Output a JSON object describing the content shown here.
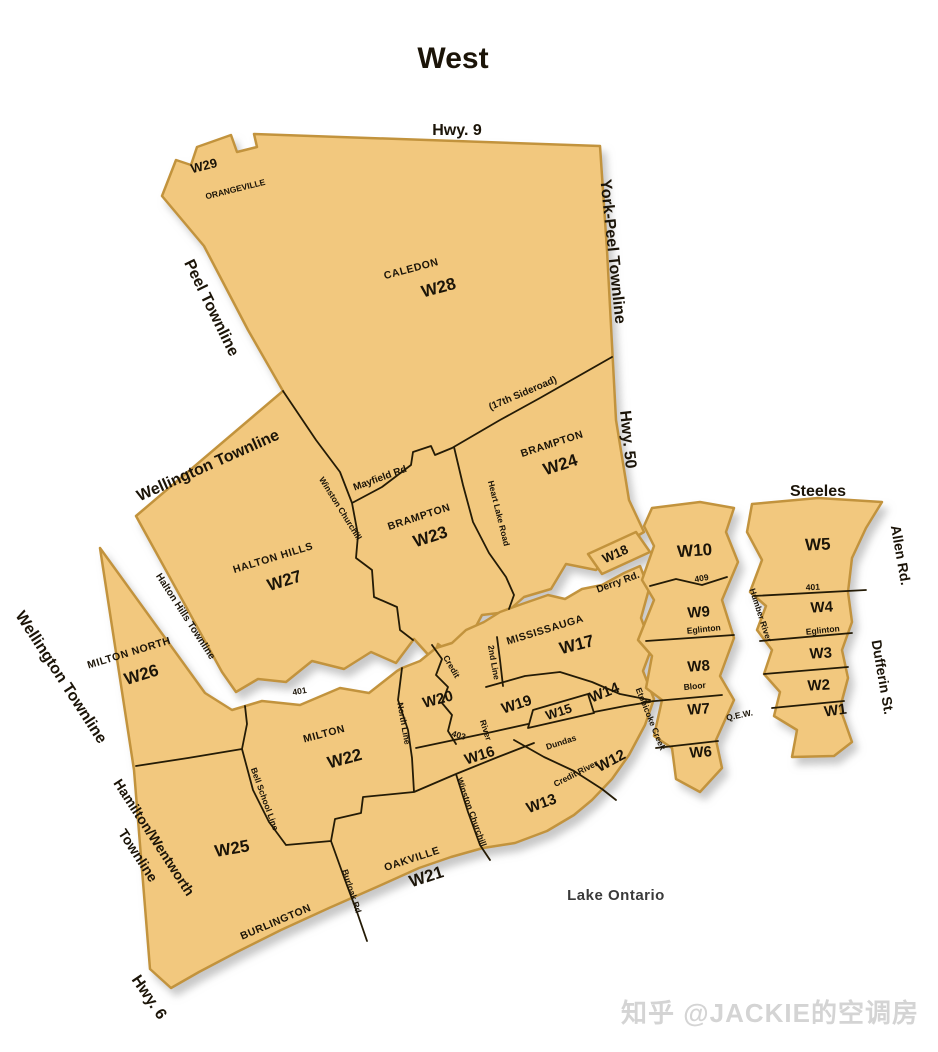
{
  "colors": {
    "background": "#FFFFFF",
    "region_fill": "#F2C87E",
    "region_edge": "#C2933C",
    "boundary_line": "#241B06",
    "label_text": "#1B1408",
    "lake_text": "#3A3A3A",
    "watermark": "#D4D4D4"
  },
  "labels": {
    "title": "West",
    "hwy9": "Hwy. 9",
    "w29": "W29",
    "orangeville": "ORANGEVILLE",
    "york_peel": "York-Peel Townline",
    "peel_townline": "Peel Townline",
    "caledon": "CALEDON",
    "w28": "W28",
    "sideroad17": "(17th Sideroad)",
    "hwy50": "Hwy. 50",
    "wellington_nw": "Wellington Townline",
    "mayfield": "Mayfield Rd",
    "winston_n": "Winston Churchill",
    "heart_lake": "Heart Lake Road",
    "brampton23": "BRAMPTON",
    "w23": "W23",
    "brampton24": "BRAMPTON",
    "w24": "W24",
    "halton_hills_name": "HALTON HILLS",
    "w27": "W27",
    "halton_hills_townline": "Halton Hills Townline",
    "milton_north": "MILTON NORTH",
    "w26": "W26",
    "wellington_sw": "Wellington Townline",
    "hamilton1": "Hamilton/Wentworth",
    "hamilton2": "Townline",
    "hwy6": "Hwy. 6",
    "w25": "W25",
    "burlington": "BURLINGTON",
    "milton": "MILTON",
    "w22": "W22",
    "oakville": "OAKVILLE",
    "w21": "W21",
    "bell_school": "Bell School Line",
    "burloak": "Burloak Rd",
    "north_line": "North Line",
    "r401a": "401",
    "r401b": "401",
    "r403": "403",
    "r409": "409",
    "credit": "Credit",
    "river": "River",
    "second_line": "2nd Line",
    "credit_river": "Credit River",
    "winston_s": "Winston Churchill",
    "mississauga": "MISSISSAUGA",
    "w17": "W17",
    "w18": "W18",
    "derry": "Derry Rd.",
    "w19": "W19",
    "w20": "W20",
    "w16": "W16",
    "w15": "W15",
    "w14": "W14",
    "w13": "W13",
    "w12": "W12",
    "dundas": "Dundas",
    "etobicoke_creek": "Etobicoke Creek",
    "humber_river": "Humber River",
    "w10": "W10",
    "w9": "W9",
    "w8": "W8",
    "w7": "W7",
    "w6": "W6",
    "eglinton9": "Eglinton",
    "bloor": "Bloor",
    "qew": "Q.E.W.",
    "steeles": "Steeles",
    "allen_rd": "Allen Rd.",
    "dufferin": "Dufferin St.",
    "w5": "W5",
    "w4": "W4",
    "w3": "W3",
    "w2": "W2",
    "w1": "W1",
    "eglinton4": "Eglinton",
    "lake_ontario": "Lake Ontario",
    "watermark": "知乎 @JACKIE的空调房"
  }
}
